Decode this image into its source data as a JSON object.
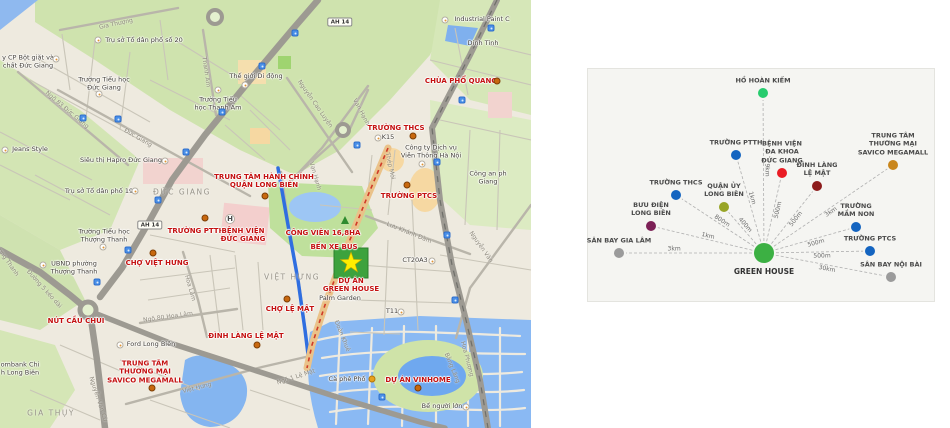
{
  "map": {
    "labels": [
      {
        "name": "poi-chua-pho-quang",
        "cls": "lbl-red",
        "x": 461,
        "y": 81,
        "lines": [
          "CHÙA PHỔ QUANG"
        ]
      },
      {
        "name": "poi-truong-thcs-map",
        "cls": "lbl-red",
        "x": 396,
        "y": 128,
        "lines": [
          "TRƯỜNG THCS"
        ]
      },
      {
        "name": "poi-truong-ptcs-map",
        "cls": "lbl-red",
        "x": 409,
        "y": 196,
        "lines": [
          "TRƯỜNG PTCS"
        ]
      },
      {
        "name": "poi-trung-tam-hanh-chinh",
        "cls": "lbl-red",
        "x": 264,
        "y": 181,
        "lines": [
          "TRUNG TÂM HÀNH CHÍNH",
          "QUẬN LONG BIÊN"
        ]
      },
      {
        "name": "poi-truong-ptth-map",
        "cls": "lbl-red",
        "x": 196,
        "y": 231,
        "lines": [
          "TRƯỜNG PTTH"
        ]
      },
      {
        "name": "poi-benh-vien-duc-giang",
        "cls": "lbl-red",
        "x": 243,
        "y": 235,
        "lines": [
          "BỆNH VIỆN",
          "ĐỨC GIANG"
        ]
      },
      {
        "name": "poi-cho-viet-hung",
        "cls": "lbl-red",
        "x": 157,
        "y": 263,
        "lines": [
          "CHỢ VIỆT HƯNG"
        ]
      },
      {
        "name": "poi-cong-vien-168ha",
        "cls": "lbl-red",
        "x": 323,
        "y": 233,
        "lines": [
          "CÔNG VIÊN 16,8HA"
        ]
      },
      {
        "name": "poi-ben-xe-bus",
        "cls": "lbl-red",
        "x": 334,
        "y": 247,
        "lines": [
          "BẾN XE BUS"
        ]
      },
      {
        "name": "poi-du-an-green-house",
        "cls": "lbl-red",
        "x": 351,
        "y": 285,
        "lines": [
          "DỰ ÁN",
          "GREEN HOUSE"
        ]
      },
      {
        "name": "poi-cho-le-mat",
        "cls": "lbl-red",
        "x": 290,
        "y": 309,
        "lines": [
          "CHỢ LỆ MẬT"
        ]
      },
      {
        "name": "poi-dinh-lang-le-mat-map",
        "cls": "lbl-red",
        "x": 246,
        "y": 336,
        "lines": [
          "ĐÌNH LÀNG LỆ MẬT"
        ]
      },
      {
        "name": "poi-nut-cau-chui",
        "cls": "lbl-red",
        "x": 76,
        "y": 321,
        "lines": [
          "NÚT CẦU CHUI"
        ]
      },
      {
        "name": "poi-savico-megamall-map",
        "cls": "lbl-red",
        "x": 145,
        "y": 372,
        "lines": [
          "TRUNG TÂM",
          "THƯƠNG MẠI",
          "SAVICO MEGAMALL"
        ]
      },
      {
        "name": "poi-du-an-vinhome",
        "cls": "lbl-red",
        "x": 418,
        "y": 380,
        "lines": [
          "DỰ ÁN VINHOME"
        ]
      },
      {
        "name": "poi-to-dan-pho-20",
        "cls": "lbl-blk",
        "x": 144,
        "y": 41,
        "lines": [
          "Trụ sở Tổ dân phố số 20"
        ]
      },
      {
        "name": "poi-bot-giat-duc-giang",
        "cls": "lbl-blk",
        "x": 28,
        "y": 62,
        "lines": [
          "y CP Bột giặt và",
          "chất Đức Giang"
        ]
      },
      {
        "name": "poi-truong-tieu-hoc-duc-giang",
        "cls": "lbl-blk",
        "x": 104,
        "y": 84,
        "lines": [
          "Trường Tiểu học",
          "Đức Giang"
        ]
      },
      {
        "name": "poi-truong-tieu-hoc-thanh-am",
        "cls": "lbl-blk",
        "x": 218,
        "y": 104,
        "lines": [
          "Trường Tiểu",
          "học Thanh Am"
        ]
      },
      {
        "name": "poi-the-gioi-di-dong",
        "cls": "lbl-blk",
        "x": 256,
        "y": 77,
        "lines": [
          "Thế giới Di động"
        ]
      },
      {
        "name": "poi-industrial-paint",
        "cls": "lbl-blk",
        "x": 482,
        "y": 20,
        "lines": [
          "Industrial Paint C"
        ]
      },
      {
        "name": "poi-dinh-tinh",
        "cls": "lbl-blk",
        "x": 483,
        "y": 44,
        "lines": [
          "Dinh Tinh"
        ]
      },
      {
        "name": "poi-jeans-style",
        "cls": "lbl-blk",
        "x": 30,
        "y": 150,
        "lines": [
          "Jeans Style"
        ]
      },
      {
        "name": "poi-hapro",
        "cls": "lbl-blk",
        "x": 121,
        "y": 161,
        "lines": [
          "Siêu thị Hapro Đức Giang"
        ]
      },
      {
        "name": "poi-to-dan-pho-19",
        "cls": "lbl-blk",
        "x": 99,
        "y": 192,
        "lines": [
          "Trụ sở Tổ dân phố 19"
        ]
      },
      {
        "name": "poi-ubnd-thuong-thanh",
        "cls": "lbl-blk",
        "x": 74,
        "y": 268,
        "lines": [
          "UBND phường",
          "Thượng Thanh"
        ]
      },
      {
        "name": "poi-truong-tieu-hoc-thuong-thanh",
        "cls": "lbl-blk",
        "x": 104,
        "y": 236,
        "lines": [
          "Trường Tiểu học",
          "Thượng Thanh"
        ]
      },
      {
        "name": "poi-ford-long-bien",
        "cls": "lbl-blk",
        "x": 151,
        "y": 345,
        "lines": [
          "Ford Long Biên"
        ]
      },
      {
        "name": "poi-bank-long-bien",
        "cls": "lbl-blk",
        "x": 20,
        "y": 369,
        "lines": [
          "ombank Chi",
          "h Long Biên"
        ]
      },
      {
        "name": "poi-vien-thong-ha-noi",
        "cls": "lbl-blk",
        "x": 431,
        "y": 152,
        "lines": [
          "Công ty Dịch vụ",
          "Viễn Thông Hà Nội"
        ]
      },
      {
        "name": "poi-cong-an",
        "cls": "lbl-blk",
        "x": 488,
        "y": 178,
        "lines": [
          "Công an ph",
          "Giang"
        ]
      },
      {
        "name": "poi-k15",
        "cls": "lbl-blk",
        "x": 388,
        "y": 138,
        "lines": [
          "K15"
        ]
      },
      {
        "name": "poi-ct20a3",
        "cls": "lbl-blk",
        "x": 415,
        "y": 261,
        "lines": [
          "CT20A3"
        ]
      },
      {
        "name": "poi-t11",
        "cls": "lbl-blk",
        "x": 392,
        "y": 312,
        "lines": [
          "T11"
        ]
      },
      {
        "name": "poi-palm-garden",
        "cls": "lbl-blk",
        "x": 340,
        "y": 299,
        "lines": [
          "Palm Garden"
        ]
      },
      {
        "name": "poi-ca-phe-pho",
        "cls": "lbl-blk",
        "x": 347,
        "y": 380,
        "lines": [
          "Cà phê Phố"
        ]
      },
      {
        "name": "poi-be-nguoi-lon",
        "cls": "lbl-blk",
        "x": 442,
        "y": 407,
        "lines": [
          "Bể người lớn"
        ]
      },
      {
        "name": "area-duc-giang",
        "cls": "lbl-area",
        "x": 182,
        "y": 193,
        "lines": [
          "ĐỨC GIANG"
        ]
      },
      {
        "name": "area-viet-hung",
        "cls": "lbl-area",
        "x": 292,
        "y": 278,
        "lines": [
          "VIỆT HƯNG"
        ]
      },
      {
        "name": "area-gia-thuy",
        "cls": "lbl-area",
        "x": 51,
        "y": 414,
        "lines": [
          "GIA THỤY"
        ]
      },
      {
        "name": "st-gia-thuong",
        "cls": "lbl-street",
        "x": 116,
        "y": 24,
        "rot": -12,
        "lines": [
          "Gia Thượng"
        ]
      },
      {
        "name": "st-thanh-am",
        "cls": "lbl-street",
        "x": 206,
        "y": 72,
        "rot": 82,
        "lines": [
          "Thanh Am"
        ]
      },
      {
        "name": "st-duc-giang",
        "cls": "lbl-street",
        "x": 138,
        "y": 138,
        "rot": 30,
        "lines": [
          "Đức Giang"
        ]
      },
      {
        "name": "st-ngo-83",
        "cls": "lbl-street",
        "x": 67,
        "y": 110,
        "rot": 40,
        "lines": [
          "Ngõ 83 Đức Giang"
        ]
      },
      {
        "name": "st-nguyen-cao-luyen",
        "cls": "lbl-street",
        "x": 315,
        "y": 104,
        "rot": 55,
        "lines": [
          "Nguyễn Cao Luyện"
        ]
      },
      {
        "name": "st-van-hanh",
        "cls": "lbl-street",
        "x": 361,
        "y": 112,
        "rot": 62,
        "lines": [
          "Vạn Hạnh"
        ]
      },
      {
        "name": "st-van-hanh-2",
        "cls": "lbl-street",
        "x": 315,
        "y": 176,
        "rot": 74,
        "lines": [
          "Vạn Hạnh"
        ]
      },
      {
        "name": "st-hoa-lam",
        "cls": "lbl-street",
        "x": 190,
        "y": 288,
        "rot": 74,
        "lines": [
          "Hoa Lâm"
        ]
      },
      {
        "name": "st-ngo-80-hoa-lam",
        "cls": "lbl-street",
        "x": 168,
        "y": 317,
        "rot": -8,
        "lines": [
          "Ngõ 80 Hoa Lâm"
        ]
      },
      {
        "name": "st-duong-5",
        "cls": "lbl-street",
        "x": 44,
        "y": 289,
        "rot": 48,
        "lines": [
          "Đường 5 kéo dài"
        ]
      },
      {
        "name": "st-thuong-thanh",
        "cls": "lbl-street",
        "x": 5,
        "y": 258,
        "rot": 55,
        "lines": [
          "Thượng Thanh"
        ]
      },
      {
        "name": "st-nguyen-van-cu",
        "cls": "lbl-street",
        "x": 98,
        "y": 399,
        "rot": 72,
        "lines": [
          "Nguyễn Văn Cừ"
        ]
      },
      {
        "name": "st-viet-hung",
        "cls": "lbl-street",
        "x": 197,
        "y": 388,
        "rot": -14,
        "lines": [
          "Việt Hưng"
        ]
      },
      {
        "name": "st-ngo-1-le-mat",
        "cls": "lbl-street",
        "x": 296,
        "y": 377,
        "rot": -18,
        "lines": [
          "Ngõ 1 Lệ Mật"
        ]
      },
      {
        "name": "st-doan-khue",
        "cls": "lbl-street",
        "x": 342,
        "y": 336,
        "rot": 68,
        "lines": [
          "Đoàn Khuê"
        ]
      },
      {
        "name": "st-luu-khanh-dam",
        "cls": "lbl-street",
        "x": 409,
        "y": 233,
        "rot": 22,
        "lines": [
          "Lưu Khánh Đàm"
        ]
      },
      {
        "name": "st-nguyen-van",
        "cls": "lbl-street",
        "x": 481,
        "y": 247,
        "rot": 55,
        "lines": [
          "Nguyễn Văn"
        ]
      },
      {
        "name": "st-thep-moi",
        "cls": "lbl-street",
        "x": 390,
        "y": 166,
        "rot": 78,
        "lines": [
          "Thép Mới"
        ]
      },
      {
        "name": "st-hoa-phuong",
        "cls": "lbl-street",
        "x": 467,
        "y": 359,
        "rot": 75,
        "lines": [
          "Hoa Phượng"
        ]
      },
      {
        "name": "st-bang-lang",
        "cls": "lbl-street",
        "x": 452,
        "y": 368,
        "rot": 68,
        "lines": [
          "Bằng Lăng"
        ]
      }
    ],
    "markers": [
      {
        "type": "m-dot",
        "name": "marker-chua-pho-quang",
        "x": 497,
        "y": 81
      },
      {
        "type": "m-dot",
        "name": "marker-truong-thcs",
        "x": 413,
        "y": 136
      },
      {
        "type": "m-dot",
        "name": "marker-truong-ptcs",
        "x": 407,
        "y": 185
      },
      {
        "type": "m-dot",
        "name": "marker-trung-tam-hanh-chinh",
        "x": 265,
        "y": 196
      },
      {
        "type": "m-dot",
        "name": "marker-truong-ptth",
        "x": 205,
        "y": 218
      },
      {
        "type": "m-dot",
        "name": "marker-cho-viet-hung",
        "x": 153,
        "y": 253
      },
      {
        "type": "m-dot",
        "name": "marker-cho-le-mat",
        "x": 287,
        "y": 299
      },
      {
        "type": "m-dot",
        "name": "marker-dinh-lang-le-mat",
        "x": 257,
        "y": 345
      },
      {
        "type": "m-dot",
        "name": "marker-savico",
        "x": 152,
        "y": 388
      },
      {
        "type": "m-dot",
        "name": "marker-vinhome",
        "x": 418,
        "y": 388
      },
      {
        "type": "m-hosp",
        "name": "hospital-icon",
        "x": 230,
        "y": 219,
        "txt": "H"
      },
      {
        "type": "m-cafe",
        "name": "cafe-icon",
        "x": 372,
        "y": 379
      },
      {
        "type": "m-poi",
        "name": "poi-icon",
        "x": 98,
        "y": 40
      },
      {
        "type": "m-poi",
        "name": "poi-icon",
        "x": 56,
        "y": 59
      },
      {
        "type": "m-poi",
        "name": "poi-icon",
        "x": 99,
        "y": 94
      },
      {
        "type": "m-poi",
        "name": "poi-icon",
        "x": 218,
        "y": 90
      },
      {
        "type": "m-poi",
        "name": "poi-icon",
        "x": 245,
        "y": 85
      },
      {
        "type": "m-poi",
        "name": "poi-icon",
        "x": 445,
        "y": 20
      },
      {
        "type": "m-poi",
        "name": "poi-icon",
        "x": 5,
        "y": 150
      },
      {
        "type": "m-poi",
        "name": "poi-icon",
        "x": 165,
        "y": 161
      },
      {
        "type": "m-poi",
        "name": "poi-icon",
        "x": 135,
        "y": 191
      },
      {
        "type": "m-poi",
        "name": "poi-icon",
        "x": 43,
        "y": 265
      },
      {
        "type": "m-poi",
        "name": "poi-icon",
        "x": 103,
        "y": 247
      },
      {
        "type": "m-poi",
        "name": "poi-icon",
        "x": 120,
        "y": 345
      },
      {
        "type": "m-poi",
        "name": "poi-icon",
        "x": 422,
        "y": 164
      },
      {
        "type": "m-poi",
        "name": "poi-icon",
        "x": 378,
        "y": 138
      },
      {
        "type": "m-poi",
        "name": "poi-icon",
        "x": 432,
        "y": 261
      },
      {
        "type": "m-poi",
        "name": "poi-icon",
        "x": 401,
        "y": 312
      },
      {
        "type": "m-poi",
        "name": "poi-icon",
        "x": 466,
        "y": 407
      },
      {
        "type": "m-bus",
        "name": "bus-stop-icon",
        "x": 83,
        "y": 118
      },
      {
        "type": "m-bus",
        "name": "bus-stop-icon",
        "x": 118,
        "y": 119
      },
      {
        "type": "m-bus",
        "name": "bus-stop-icon",
        "x": 262,
        "y": 66
      },
      {
        "type": "m-bus",
        "name": "bus-stop-icon",
        "x": 295,
        "y": 33
      },
      {
        "type": "m-bus",
        "name": "bus-stop-icon",
        "x": 222,
        "y": 112
      },
      {
        "type": "m-bus",
        "name": "bus-stop-icon",
        "x": 186,
        "y": 152
      },
      {
        "type": "m-bus",
        "name": "bus-stop-icon",
        "x": 158,
        "y": 200
      },
      {
        "type": "m-bus",
        "name": "bus-stop-icon",
        "x": 128,
        "y": 250
      },
      {
        "type": "m-bus",
        "name": "bus-stop-icon",
        "x": 97,
        "y": 282
      },
      {
        "type": "m-bus",
        "name": "bus-stop-icon",
        "x": 491,
        "y": 28
      },
      {
        "type": "m-bus",
        "name": "bus-stop-icon",
        "x": 462,
        "y": 100
      },
      {
        "type": "m-bus",
        "name": "bus-stop-icon",
        "x": 437,
        "y": 162
      },
      {
        "type": "m-bus",
        "name": "bus-stop-icon",
        "x": 447,
        "y": 235
      },
      {
        "type": "m-bus",
        "name": "bus-stop-icon",
        "x": 455,
        "y": 300
      },
      {
        "type": "m-bus",
        "name": "bus-stop-icon",
        "x": 382,
        "y": 397
      },
      {
        "type": "m-bus",
        "name": "bus-stop-icon",
        "x": 357,
        "y": 145
      },
      {
        "type": "m-badge",
        "name": "route-badge-ah14",
        "x": 340,
        "y": 22,
        "txt": "AH 14"
      },
      {
        "type": "m-badge",
        "name": "route-badge-ah14",
        "x": 150,
        "y": 225,
        "txt": "AH 14"
      }
    ]
  },
  "diagram": {
    "panel": {
      "x": 587,
      "y": 68,
      "w": 346,
      "h": 232
    },
    "center": {
      "name": "green-house",
      "label": "GREEN HOUSE",
      "x": 764,
      "y": 253,
      "r": 10,
      "color": "#3cb043"
    },
    "nodes": [
      {
        "name": "ho-hoan-kiem",
        "lines": [
          "HỒ HOÀN KIẾM"
        ],
        "x": 763,
        "y": 93,
        "r": 5,
        "color": "#27cc6e",
        "distance": "9km",
        "t": 0.52
      },
      {
        "name": "truong-ptth",
        "lines": [
          "TRƯỜNG PTTH"
        ],
        "x": 736,
        "y": 155,
        "r": 5,
        "color": "#1464c0",
        "distance": "1km",
        "t": 0.55
      },
      {
        "name": "benh-vien-da-khoa-duc-giang",
        "lines": [
          "BỆNH VIỆN",
          "ĐA KHOA",
          "ĐỨC GIANG"
        ],
        "x": 782,
        "y": 173,
        "r": 5,
        "color": "#ea1c24",
        "distance": "500m",
        "t": 0.55
      },
      {
        "name": "dinh-lang-le-mat",
        "lines": [
          "ĐÌNH LÀNG",
          "LỆ MẬT"
        ],
        "x": 817,
        "y": 186,
        "r": 5,
        "color": "#8c1b1b",
        "distance": "500m",
        "t": 0.55
      },
      {
        "name": "trung-tam-thuong-mai-savico-megamall",
        "lines": [
          "TRUNG TÂM",
          "THƯƠNG MẠI",
          "SAVICO MEGAMALL"
        ],
        "x": 893,
        "y": 165,
        "r": 5,
        "color": "#c9861c",
        "distance": "3km",
        "t": 0.5
      },
      {
        "name": "truong-thcs",
        "lines": [
          "TRƯỜNG THCS"
        ],
        "x": 676,
        "y": 195,
        "r": 5,
        "color": "#1464c0",
        "distance": "800m",
        "t": 0.5
      },
      {
        "name": "quan-uy-long-bien",
        "lines": [
          "QUẬN ỦY",
          "LONG BIÊN"
        ],
        "x": 724,
        "y": 207,
        "r": 5,
        "color": "#98a527",
        "distance": "400m",
        "t": 0.55
      },
      {
        "name": "buu-dien-long-bien",
        "lines": [
          "BƯU ĐIỆN",
          "LONG BIÊN"
        ],
        "x": 651,
        "y": 226,
        "r": 5,
        "color": "#7c2056",
        "distance": "1km",
        "t": 0.5
      },
      {
        "name": "truong-mam-non",
        "lines": [
          "TRƯỜNG",
          "MẦM NON"
        ],
        "x": 856,
        "y": 227,
        "r": 5,
        "color": "#1464c0",
        "distance": "500m",
        "t": 0.55
      },
      {
        "name": "san-bay-gia-lam",
        "lines": [
          "SÂN BAY GIA LÂM"
        ],
        "x": 619,
        "y": 253,
        "r": 5,
        "color": "#9b9b9b",
        "distance": "3km",
        "t": 0.62
      },
      {
        "name": "truong-ptcs",
        "lines": [
          "TRƯỜNG PTCS"
        ],
        "x": 870,
        "y": 251,
        "r": 5,
        "color": "#1464c0",
        "distance": "500m",
        "t": 0.55
      },
      {
        "name": "san-bay-noi-bai",
        "lines": [
          "SÂN BAY NỘI BÀI"
        ],
        "x": 891,
        "y": 277,
        "r": 5,
        "color": "#9b9b9b",
        "distance": "30km",
        "t": 0.5
      }
    ]
  }
}
